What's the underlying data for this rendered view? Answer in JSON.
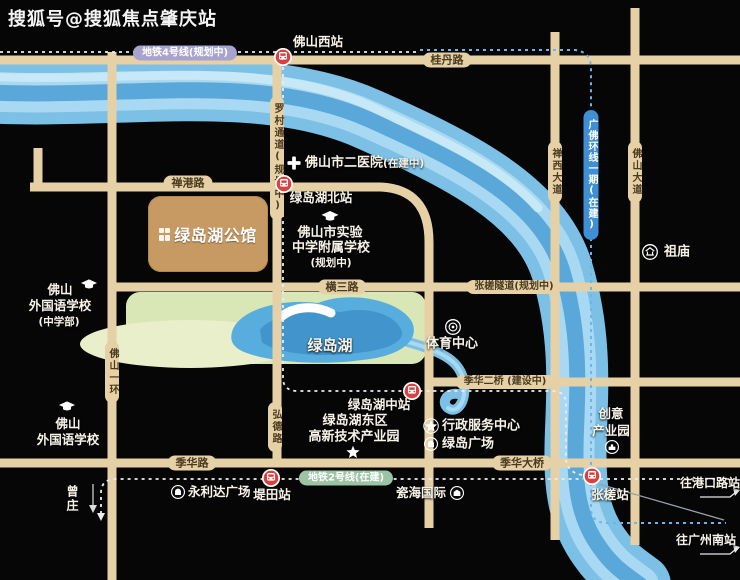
{
  "watermark": "搜狐号@搜狐焦点肇庆站",
  "project": {
    "name": "绿岛湖公馆"
  },
  "lake": {
    "name": "绿岛湖"
  },
  "colors": {
    "road": "#e6d0a6",
    "river": "#7cc0e6",
    "lake": "#57aede",
    "park": "#d9e6b6",
    "station_red": "#d94040",
    "line4_pill": "#a7a3cf",
    "line2_pill": "#9cc4a4",
    "ring_pill": "#3f8fd4",
    "label_text": "#f7f3e8",
    "road_text": "#4a3a1e"
  },
  "metro": {
    "line4": {
      "label": "地铁4号线(规划中)"
    },
    "line2": {
      "label": "地铁2号线(在建)"
    },
    "guangfo_ring": {
      "label": "广佛环线一期(在建)"
    },
    "stations": {
      "foshan_west": "佛山西站",
      "lvdaohu_north": "绿岛湖北站",
      "lvdaohu_middle": "绿岛湖中站",
      "titian": "堤田站",
      "zhangcha": "张槎站"
    }
  },
  "roads": {
    "guidan": "桂丹路",
    "changang": "禅港路",
    "hengsan": "横三路",
    "zhangcha_tunnel": "张槎隧道(规划中)",
    "jihua_second_bridge": "季华二桥 (建设中)",
    "jihua": "季华路",
    "jihua_bridge": "季华大桥",
    "foshan_ring": "佛山一环",
    "luocun_channel": "罗村通道(规划中)",
    "hongde": "弘德路",
    "chanxi_avenue": "禅西大道",
    "foshan_avenue": "佛山大道"
  },
  "pois": {
    "hospital": {
      "name": "佛山市二医院",
      "status": "(在建中)"
    },
    "experimental_school": {
      "line1": "佛山市实验",
      "line2": "中学附属学校",
      "line3": "(规划中)"
    },
    "zumiao": {
      "name": "祖庙"
    },
    "sports_center": {
      "name": "体育中心"
    },
    "hitech_park": {
      "line1": "绿岛湖东区",
      "line2": "高新技术产业园"
    },
    "admin_center": {
      "name": "行政服务中心"
    },
    "lvdao_plaza": {
      "name": "绿岛广场"
    },
    "creative_park": {
      "line1": "创意",
      "line2": "产业园"
    },
    "foreign_school_middle": {
      "line1": "佛山",
      "line2": "外国语学校",
      "line3": "(中学部)"
    },
    "foreign_school": {
      "line1": "佛山",
      "line2": "外国语学校"
    },
    "yonglida_plaza": {
      "name": "永利达广场"
    },
    "cihai_international": {
      "name": "瓷海国际"
    }
  },
  "directions": {
    "to_gangkou": "往港口路站",
    "to_guangzhou_south": "往广州南站",
    "zengzhuang": "曾庄"
  }
}
